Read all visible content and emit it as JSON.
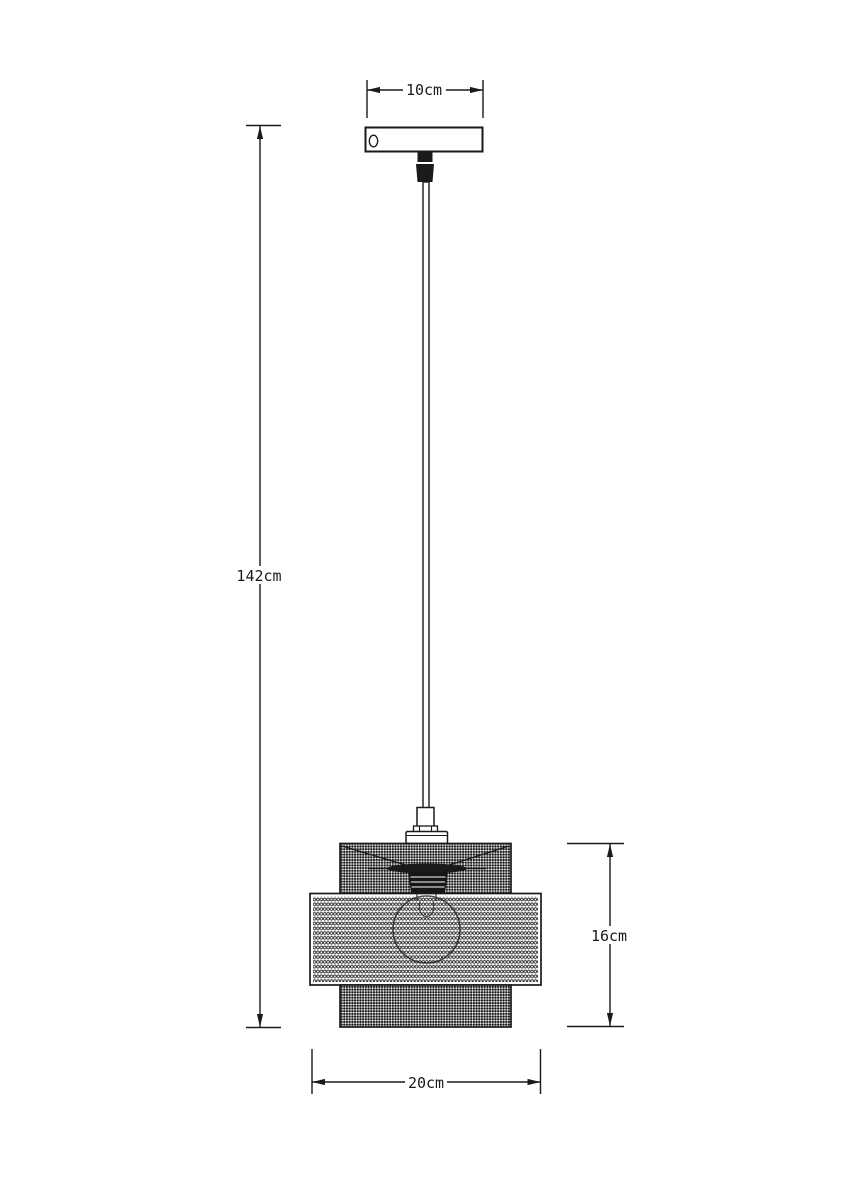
{
  "drawing": {
    "labels": {
      "plate_width": "10cm",
      "overall_height": "142cm",
      "shade_height": "16cm",
      "shade_width": "20cm"
    },
    "colors": {
      "ink": "#1a1a1a",
      "paper": "#ffffff",
      "mesh_dark": "#181818",
      "mesh_light": "#f6f6f6",
      "socket_fill": "#161616"
    }
  }
}
